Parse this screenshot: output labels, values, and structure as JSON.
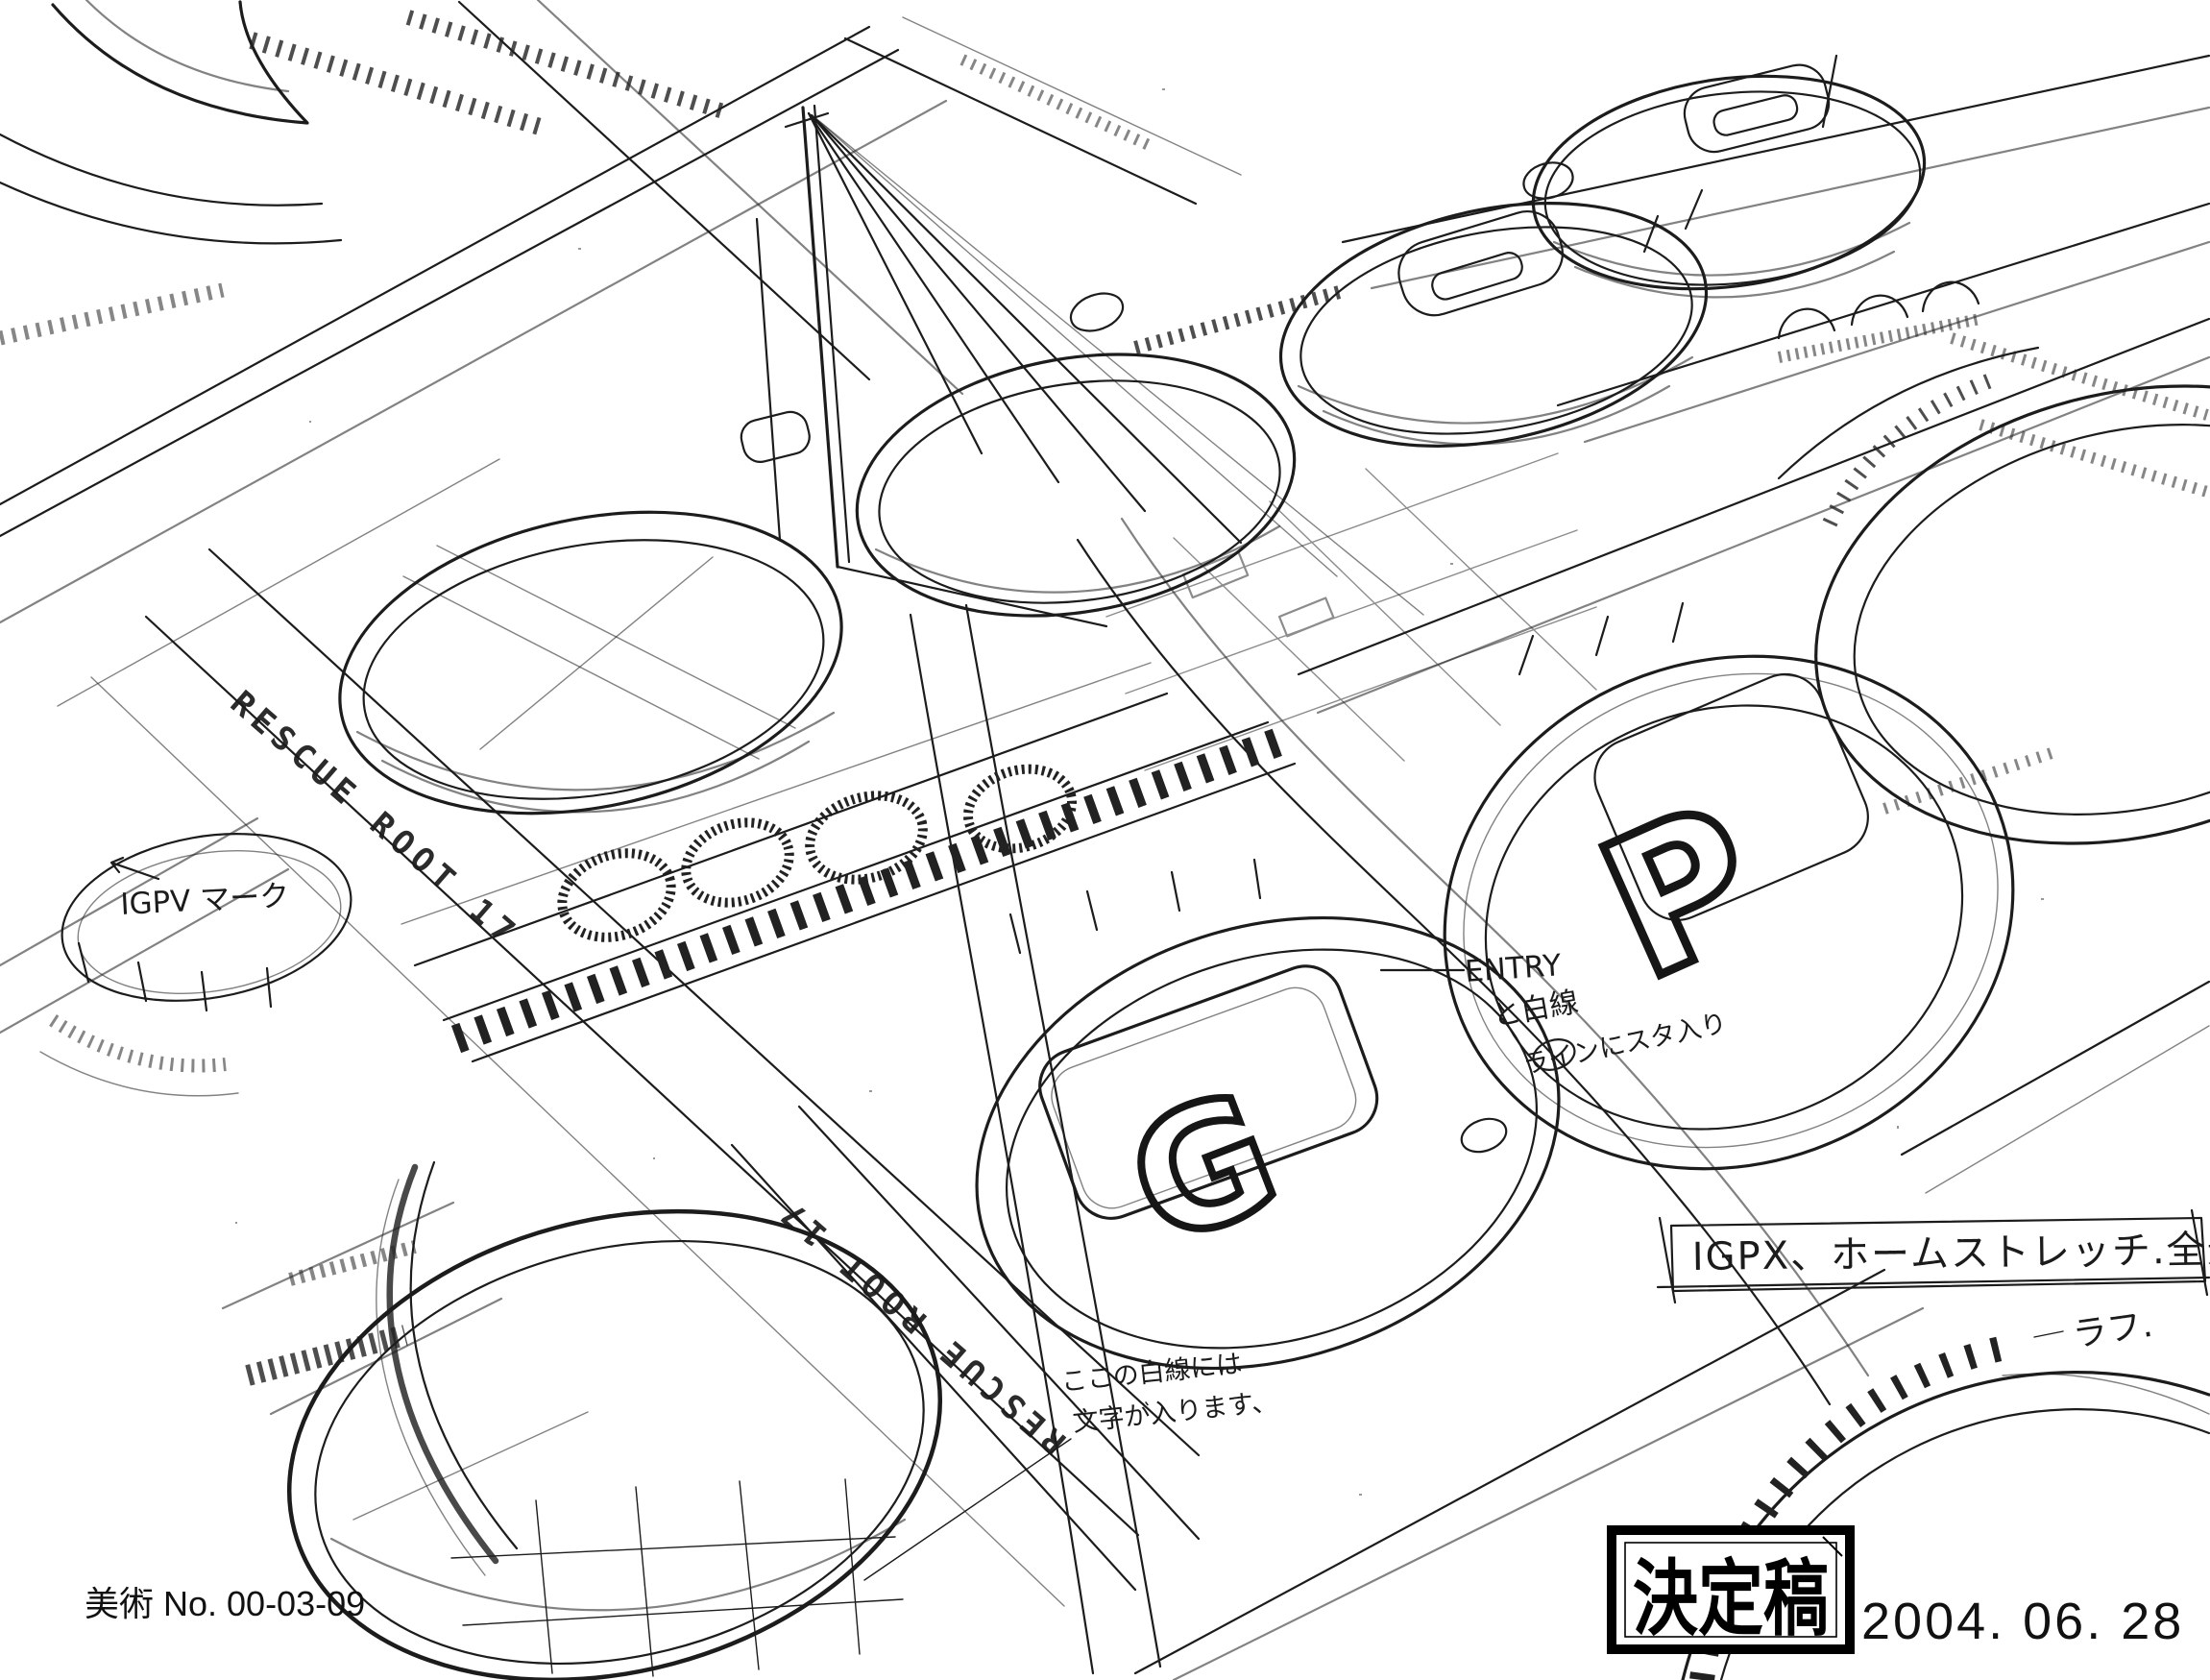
{
  "colors": {
    "ink": "#1c1c1c",
    "paper": "#ffffff",
    "stamp": "#000000"
  },
  "road_labels": {
    "upper": "RESCUE ROOT 17",
    "lower": "RESCUE ROOT 17"
  },
  "pad_letters": {
    "g": "G",
    "p": "P"
  },
  "annotations": {
    "igpx_mark": "IGPV マーク",
    "entry": {
      "l1": "ENTRY",
      "l2": "と白線",
      "l3": "ラインにスタ入り"
    },
    "white_note": {
      "l1": "ここの白線には",
      "l2": "文字が入ります、"
    },
    "title_box": "IGPX、ホームストレッチ.全景",
    "rough": "ラフ."
  },
  "footer": {
    "sheet_no": "美術 No. 00-03-09"
  },
  "stamp": {
    "text": "決定稿",
    "date": "2004. 06. 28"
  }
}
